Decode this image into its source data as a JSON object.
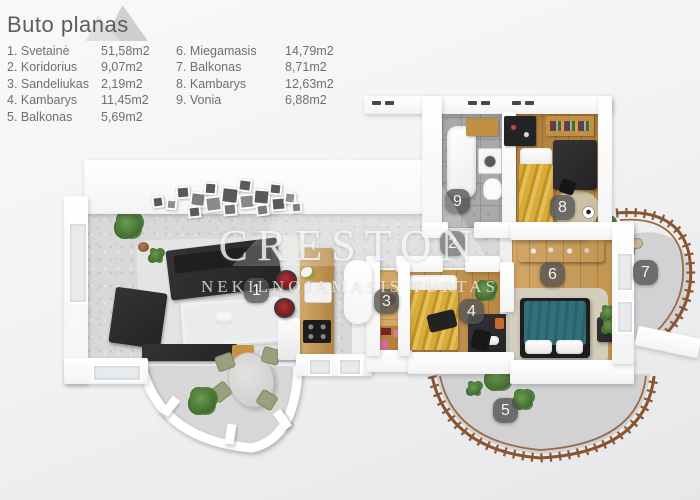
{
  "title": "Buto planas",
  "legend": {
    "col1": [
      {
        "label": "1. Svetainė",
        "area": "51,58m2"
      },
      {
        "label": "2. Koridorius",
        "area": "9,07m2"
      },
      {
        "label": "3. Sandeliukas",
        "area": "2,19m2"
      },
      {
        "label": "4. Kambarys",
        "area": "11,45m2"
      },
      {
        "label": "5. Balkonas",
        "area": "5,69m2"
      }
    ],
    "col2": [
      {
        "label": "6. Miegamasis",
        "area": "14,79m2"
      },
      {
        "label": "7. Balkonas",
        "area": "8,71m2"
      },
      {
        "label": "8. Kambarys",
        "area": "12,63m2"
      },
      {
        "label": "9. Vonia",
        "area": "6,88m2"
      }
    ]
  },
  "watermark": {
    "brand": "CRESTON",
    "tagline": "NEKILNOJAMASIS TURTAS"
  },
  "plan": {
    "badges": [
      {
        "number": "1",
        "room": "Svetainė"
      },
      {
        "number": "2",
        "room": "Koridorius"
      },
      {
        "number": "3",
        "room": "Sandeliukas"
      },
      {
        "number": "4",
        "room": "Kambarys"
      },
      {
        "number": "5",
        "room": "Balkonas"
      },
      {
        "number": "6",
        "room": "Miegamasis"
      },
      {
        "number": "7",
        "room": "Balkonas"
      },
      {
        "number": "8",
        "room": "Kambarys"
      },
      {
        "number": "9",
        "room": "Vonia"
      }
    ]
  },
  "colors": {
    "wall": "#ffffff",
    "floor_gray": "#d8d8d8",
    "wood": "#c6934a",
    "gold_bed": "#d4a433",
    "teal_bed": "#2f6e74",
    "railing": "#8a5431",
    "stool_red": "#8e2026",
    "badge_bg": "#555555"
  }
}
